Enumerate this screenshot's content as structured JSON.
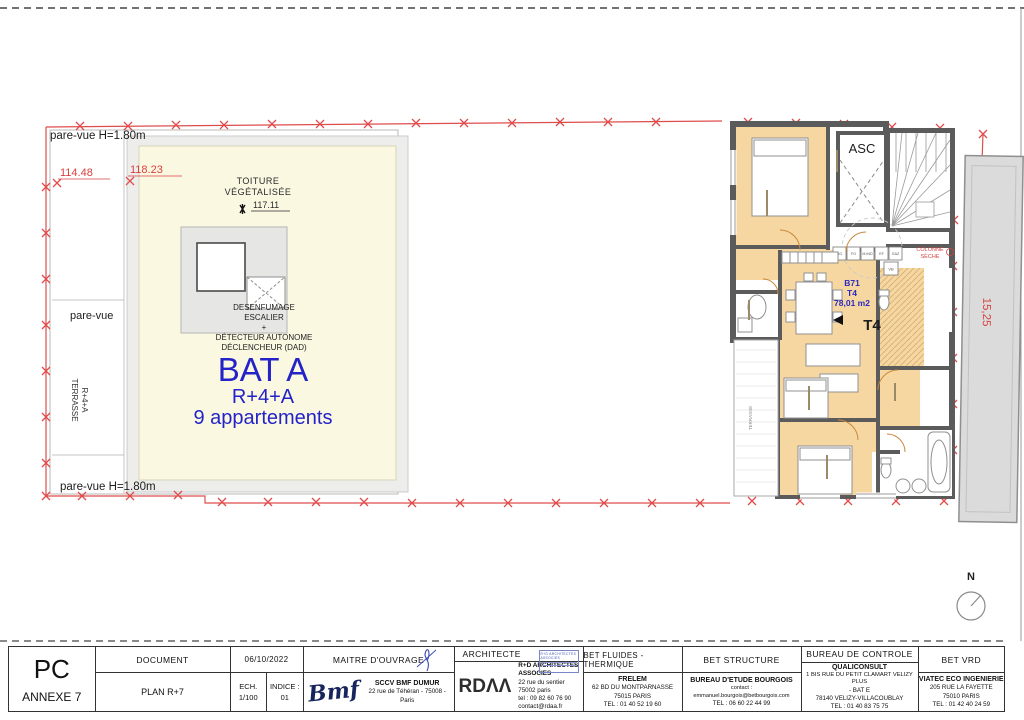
{
  "sheet": {
    "type_label": "PC",
    "annex_label": "ANNEXE 7",
    "doc_header": "DOCUMENT",
    "doc_name": "PLAN R+7",
    "date": "06/10/2022",
    "scale_label": "ECH.",
    "scale_value": "1/100",
    "indice_label": "INDICE :",
    "indice_value": "01"
  },
  "site": {
    "pare_vue_top": "pare-vue H=1.80m",
    "pare_vue_left": "pare-vue",
    "pare_vue_bottom": "pare-vue H=1.80m",
    "terrasse_line1": "TERRASSE",
    "terrasse_line2": "R+4+A",
    "dim_left": "114.48",
    "dim_right": "118.23",
    "roof_line1": "TOITURE",
    "roof_line2": "VÉGÉTALISÉE",
    "roof_level": "117.11",
    "smoke1": "DESENFUMAGE",
    "smoke2": "ESCALIER",
    "smoke_plus": "+",
    "smoke3": "DÉTECTEUR AUTONOME",
    "smoke4": "DÉCLENCHEUR (DAD)",
    "bat_title": "BAT A",
    "bat_floors": "R+4+A",
    "bat_units": "9 appartements"
  },
  "plan": {
    "elevator": "ASC",
    "dry_column_line1": "COLONNE",
    "dry_column_line2": "SÈCHE",
    "apt_code": "B71",
    "apt_type": "T4",
    "apt_area": "78,01 m2",
    "apt_type_big": "T4",
    "meters": [
      "SG",
      "FO",
      "M.IND",
      "EF",
      "GAZ"
    ],
    "meter_vb": "VB",
    "terrace_side": "TERRASSE",
    "dim_vertical": "15,25",
    "north": "N"
  },
  "title_block": {
    "maitre": {
      "header": "MAITRE D'OUVRAGE",
      "logo": "Bmf",
      "name": "SCCV BMF DUMUR",
      "address": "22 rue de Téhéran - 75008 - Paris"
    },
    "architecte": {
      "header": "ARCHITECTE",
      "stamp": "R+D ARCHITECTES ASSOCIES",
      "logo": "RDΛΛ",
      "name": "R+D ARCHITECTES ASSOCIES",
      "lines": [
        "22 rue du sentier",
        "75002 paris",
        "tel : 09 82 60 76 90",
        "contact@rdaa.fr"
      ]
    },
    "fluides": {
      "header": "BET FLUIDES - THERMIQUE",
      "name": "FRELEM",
      "lines": [
        "62 BD DU MONTPARNASSE",
        "75015 PARIS",
        "TEL : 01 40 52 19 60"
      ]
    },
    "structure": {
      "header": "BET STRUCTURE",
      "name": "BUREAU D'ETUDE BOURGOIS",
      "lines": [
        "contact : emmanuel.bourgois@betbourgois.com",
        "TEL : 06 60 22 44 99"
      ]
    },
    "controle": {
      "header": "BUREAU DE CONTROLE",
      "name": "QUALICONSULT",
      "lines": [
        "1 BIS RUE DU PETIT CLAMART VELIZY PLUS",
        "- BAT E",
        "78140 VELIZY-VILLACOUBLAY",
        "TEL : 01 40 83 75 75"
      ]
    },
    "vrd": {
      "header": "BET VRD",
      "name": "VIATEC ECO INGENIERIE",
      "lines": [
        "205 RUE LA FAYETTE",
        "75010 PARIS",
        "TEL : 01 42 40 24 59"
      ]
    }
  },
  "colors": {
    "boundary_red": "#e04c4c",
    "label_blue": "#2323c8",
    "wall_gray": "#5b5b5b",
    "room_orange": "#f6d7a2",
    "roof_yellow": "#fbf8e2"
  }
}
